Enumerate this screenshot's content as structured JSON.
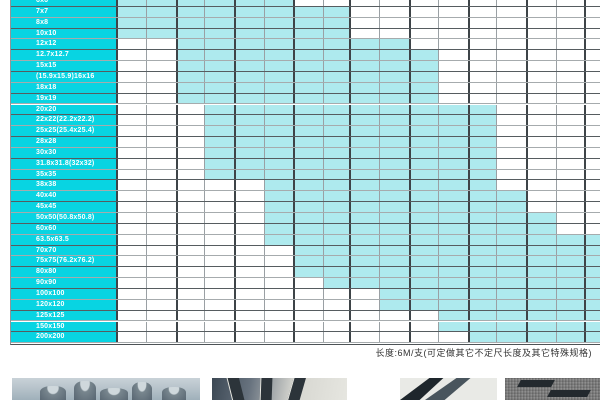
{
  "table": {
    "description_name": "square-size-availability-grid",
    "columns": 17,
    "col_widths": [
      30,
      30,
      28,
      30,
      30,
      29,
      30,
      26,
      30,
      30,
      29,
      30,
      28,
      30,
      30,
      28,
      17
    ],
    "label_col_width": 105,
    "rows": [
      {
        "label": "6x6",
        "start": 1,
        "end": 6
      },
      {
        "label": "7x7",
        "start": 1,
        "end": 8
      },
      {
        "label": "8x8",
        "start": 1,
        "end": 8
      },
      {
        "label": "10x10",
        "start": 1,
        "end": 8
      },
      {
        "label": "12x12",
        "start": 3,
        "end": 10
      },
      {
        "label": "12.7x12.7",
        "start": 3,
        "end": 11
      },
      {
        "label": "15x15",
        "start": 3,
        "end": 11
      },
      {
        "label": "(15.9x15.9)16x16",
        "start": 3,
        "end": 11
      },
      {
        "label": "18x18",
        "start": 3,
        "end": 11
      },
      {
        "label": "19x19",
        "start": 3,
        "end": 11
      },
      {
        "label": "20x20",
        "start": 4,
        "end": 13
      },
      {
        "label": "22x22(22.2x22.2)",
        "start": 4,
        "end": 13
      },
      {
        "label": "25x25(25.4x25.4)",
        "start": 4,
        "end": 13
      },
      {
        "label": "28x28",
        "start": 4,
        "end": 13
      },
      {
        "label": "30x30",
        "start": 4,
        "end": 13
      },
      {
        "label": "31.8x31.8(32x32)",
        "start": 4,
        "end": 13
      },
      {
        "label": "35x35",
        "start": 4,
        "end": 13
      },
      {
        "label": "38x38",
        "start": 6,
        "end": 13
      },
      {
        "label": "40x40",
        "start": 6,
        "end": 14
      },
      {
        "label": "45x45",
        "start": 6,
        "end": 14
      },
      {
        "label": "50x50(50.8x50.8)",
        "start": 6,
        "end": 15
      },
      {
        "label": "60x60",
        "start": 6,
        "end": 15
      },
      {
        "label": "63.5x63.5",
        "start": 6,
        "end": 17
      },
      {
        "label": "70x70",
        "start": 7,
        "end": 17
      },
      {
        "label": "75x75(76.2x76.2)",
        "start": 7,
        "end": 17
      },
      {
        "label": "80x80",
        "start": 7,
        "end": 17
      },
      {
        "label": "90x90",
        "start": 8,
        "end": 17
      },
      {
        "label": "100x100",
        "start": 10,
        "end": 17
      },
      {
        "label": "120x120",
        "start": 10,
        "end": 17
      },
      {
        "label": "125x125",
        "start": 12,
        "end": 17
      },
      {
        "label": "150x150",
        "start": 12,
        "end": 17
      },
      {
        "label": "200x200",
        "start": 13,
        "end": 17
      }
    ]
  },
  "caption": {
    "text": "长度:6M/支(可定做其它不定尺长度及其它特殊规格)"
  },
  "colors": {
    "label_bg": "#08d4e2",
    "cell_available": "#aeeaee",
    "grid_thick": "#3e4448",
    "grid_thin": "#9aa0a4"
  },
  "photos": {
    "items": [
      "round-steel-billets",
      "flat-steel-bars",
      "angle-steel-profile",
      "special-steel-profiles"
    ]
  }
}
